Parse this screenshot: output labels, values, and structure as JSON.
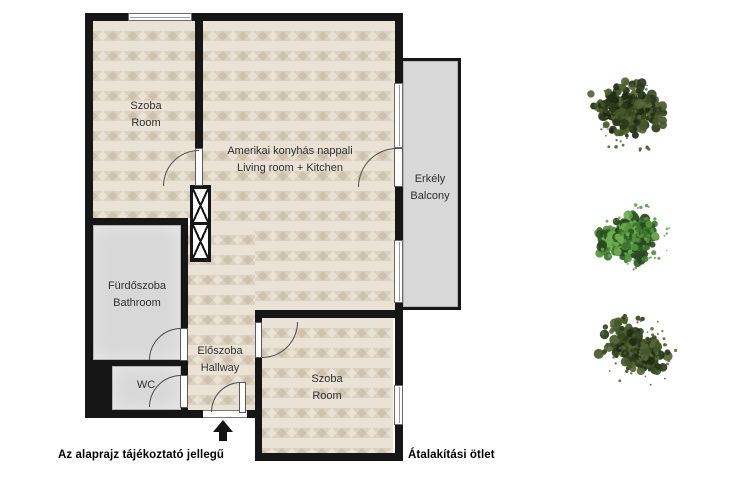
{
  "rooms": {
    "bedroom_top": {
      "name_hu": "Szoba",
      "name_en": "Room"
    },
    "living": {
      "name_hu": "Amerikai konyhás nappali",
      "name_en": "Living room + Kitchen"
    },
    "balcony": {
      "name_hu": "Erkély",
      "name_en": "Balcony"
    },
    "bathroom": {
      "name_hu": "Fürdőszoba",
      "name_en": "Bathroom"
    },
    "hallway": {
      "name_hu": "Előszoba",
      "name_en": "Hallway"
    },
    "wc": {
      "name_hu": "WC"
    },
    "bedroom_bottom": {
      "name_hu": "Szoba",
      "name_en": "Room"
    }
  },
  "notes": {
    "disclaimer": "Az alaprajz tájékoztató jellegű",
    "variant": "Átalakítási ötlet"
  },
  "colors": {
    "wall": "#161616",
    "wood": "#eae2d4",
    "tile": "#d8d8d8",
    "text": "#2f2f2f",
    "tree_dark": [
      "#2c3a1c",
      "#37491f",
      "#1f2b12",
      "#45582a",
      "#556639"
    ],
    "tree_bright": [
      "#2f5a26",
      "#3d7531",
      "#27491f",
      "#55953f",
      "#6fae52"
    ]
  }
}
